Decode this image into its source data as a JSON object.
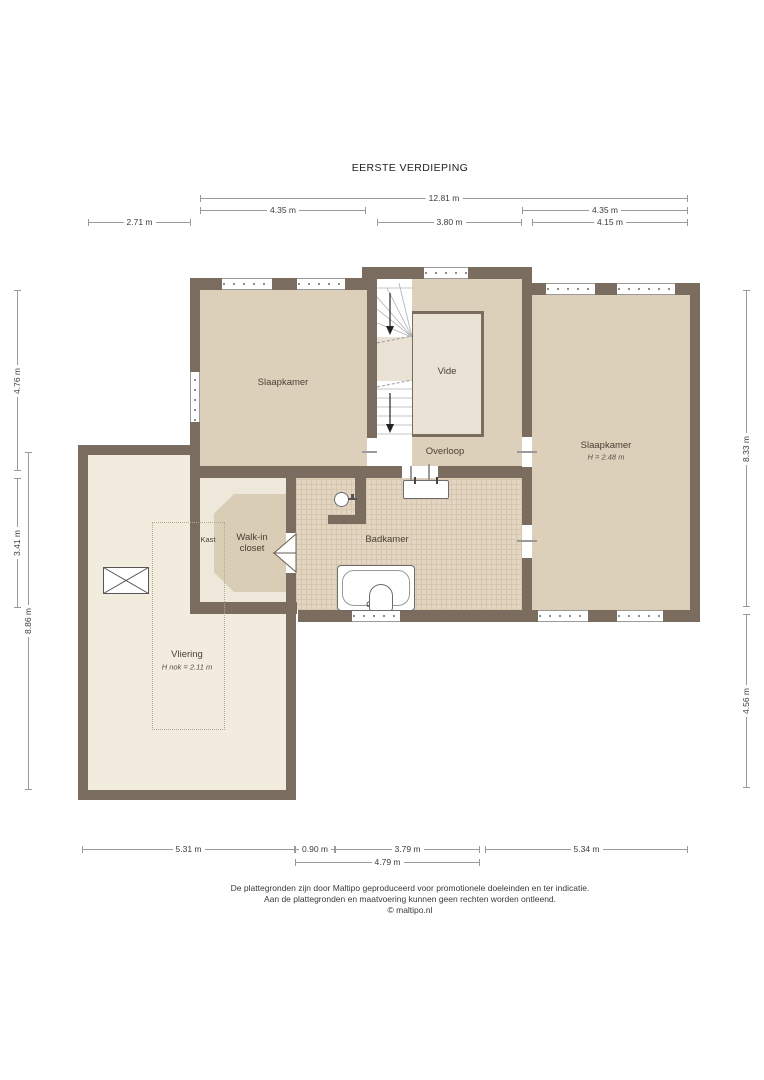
{
  "title": "EERSTE VERDIEPING",
  "colors": {
    "wall": "#7b6c60",
    "floor_main": "#dcd0bb",
    "floor_light": "#e9e2d5",
    "floor_closet": "#eee8db",
    "floor_closet_inner": "#d9cdb6",
    "floor_bath": "#e3d5c1",
    "bath_grid": "#d5c6ae",
    "floor_vliering": "#f2ecdf",
    "dim": "#9a9a9a"
  },
  "rooms": {
    "bedroom_left": {
      "label": "Slaapkamer"
    },
    "vide": {
      "label": "Vide"
    },
    "overloop": {
      "label": "Overloop"
    },
    "bedroom_right": {
      "label": "Slaapkamer",
      "height_note": "H = 2.48 m"
    },
    "kast": {
      "label": "Kast"
    },
    "walk_in_closet": {
      "label_line1": "Walk-in",
      "label_line2": "closet"
    },
    "badkamer": {
      "label": "Badkamer"
    },
    "vliering": {
      "label": "Vliering",
      "height_note": "H nok = 2.11 m"
    }
  },
  "dimensions": {
    "top": {
      "total": "12.81 m",
      "left_room": "4.35 m",
      "right_room": "4.35 m",
      "vliering_offset": "2.71 m",
      "stairs": "3.80 m",
      "bedroom_right": "4.15 m"
    },
    "left": {
      "bedroom": "4.76 m",
      "closet": "3.41 m",
      "vliering": "8.86 m"
    },
    "right": {
      "bedroom": "8.33 m",
      "lower": "4.56 m"
    },
    "bottom": {
      "vliering": "5.31 m",
      "gap": "0.90 m",
      "badkamer": "3.79 m",
      "bedroom": "5.34 m",
      "badkamer_total": "4.79 m"
    }
  },
  "footer": {
    "line1": "De plattegronden zijn door Maltipo geproduceerd voor promotionele doeleinden en ter indicatie.",
    "line2": "Aan de plattegronden en maatvoering kunnen geen rechten worden ontleend.",
    "line3": "© maltipo.nl"
  }
}
